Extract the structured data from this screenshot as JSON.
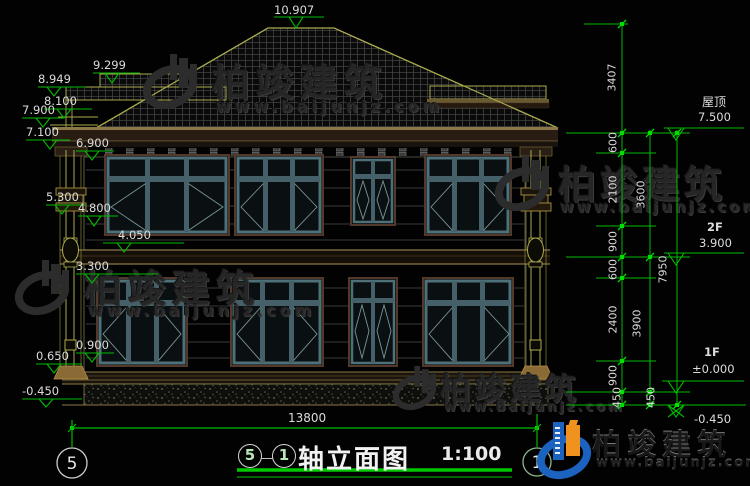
{
  "drawing": {
    "overall_dimension": "13800",
    "elev_left": [
      "10.907",
      "9.299",
      "8.949",
      "8.100",
      "7.900",
      "7.100",
      "6.900",
      "5.300",
      "4.800",
      "4.050",
      "3.300",
      "0.900",
      "0.650",
      "-0.450"
    ],
    "levels_right": {
      "roof_label": "屋顶",
      "roof_value": "7.500",
      "f2_label": "2F",
      "f2_value": "3.900",
      "f1_label": "1F",
      "f1_value": "±0.000",
      "ground_value": "-0.450"
    },
    "dims_inner": [
      "3407",
      "600",
      "2100",
      "900",
      "600",
      "2400",
      "900",
      "450"
    ],
    "dims_mid": [
      "3600",
      "3900",
      "450"
    ],
    "dims_outer": [
      "7950"
    ],
    "axis_bubbles": {
      "left": "5",
      "right": "1"
    },
    "title_block": {
      "axis_from": "5",
      "separator": "—",
      "axis_to": "1",
      "title": "轴立面图",
      "scale": "1:100"
    }
  },
  "watermark": {
    "brand": "柏竣建筑",
    "url": "www.baijunjz.com"
  },
  "colors": {
    "dimension_green": "#00bb00",
    "cad_yellow": "#aaaa4e",
    "window_frame": "#4e7078",
    "logo_blue": "#1b63bf",
    "logo_orange": "#f0931e"
  }
}
